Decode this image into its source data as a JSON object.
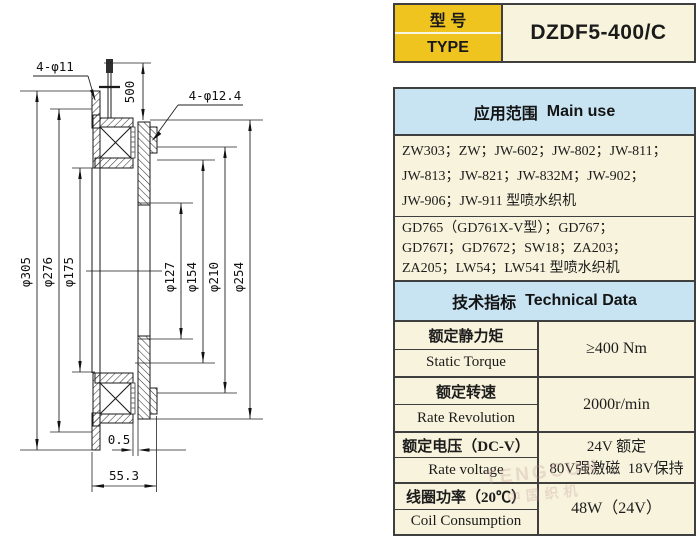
{
  "colors": {
    "yellow": "#EFC41F",
    "cream": "#F8F3DC",
    "header_blue": "#C8E4F2",
    "border": "#3F3F3F",
    "ink": "#1C1C1C"
  },
  "type_plate": {
    "label_cn": "型 号",
    "label_en": "TYPE",
    "model": "DZDF5-400/C"
  },
  "main_use": {
    "title_cn": "应用范围",
    "title_en": "Main use",
    "group1_lines": [
      "ZW303；ZW；JW-602；JW-802；JW-811；",
      "JW-813；JW-821；JW-832M；JW-902；",
      "JW-906；JW-911 型喷水织机"
    ],
    "group2_lines": [
      "GD765（GD761X-V型）；GD767；",
      "GD767I；GD7672；SW18；ZA203；",
      "ZA205；LW54；LW541 型喷水织机"
    ]
  },
  "technical": {
    "title_cn": "技术指标",
    "title_en": "Technical Data",
    "rows": [
      {
        "cn": "额定静力矩",
        "en": "Static Torque",
        "value": "≥400 Nm"
      },
      {
        "cn": "额定转速",
        "en": "Rate Revolution",
        "value": "2000r/min"
      },
      {
        "cn": "额定电压（DC-V）",
        "en": "Rate voltage",
        "value": "24V 额定",
        "value2": "80V强激磁  18V保持"
      },
      {
        "cn": "线圈功率（20℃）",
        "en": "Coil Consumption",
        "value": "48W（24V）"
      }
    ]
  },
  "drawing": {
    "dims": {
      "d305": "φ305",
      "d276": "φ276",
      "d175": "φ175",
      "d127": "φ127",
      "d154": "φ154",
      "d210": "φ210",
      "d254": "φ254"
    },
    "wire_length": "500",
    "flange_holes": "4-φ11",
    "armature_holes": "4-φ12.4",
    "air_gap": "0.5",
    "total_width": "55.3"
  },
  "watermark": {
    "line1": "TENGCUN",
    "line2": "中国织机"
  }
}
